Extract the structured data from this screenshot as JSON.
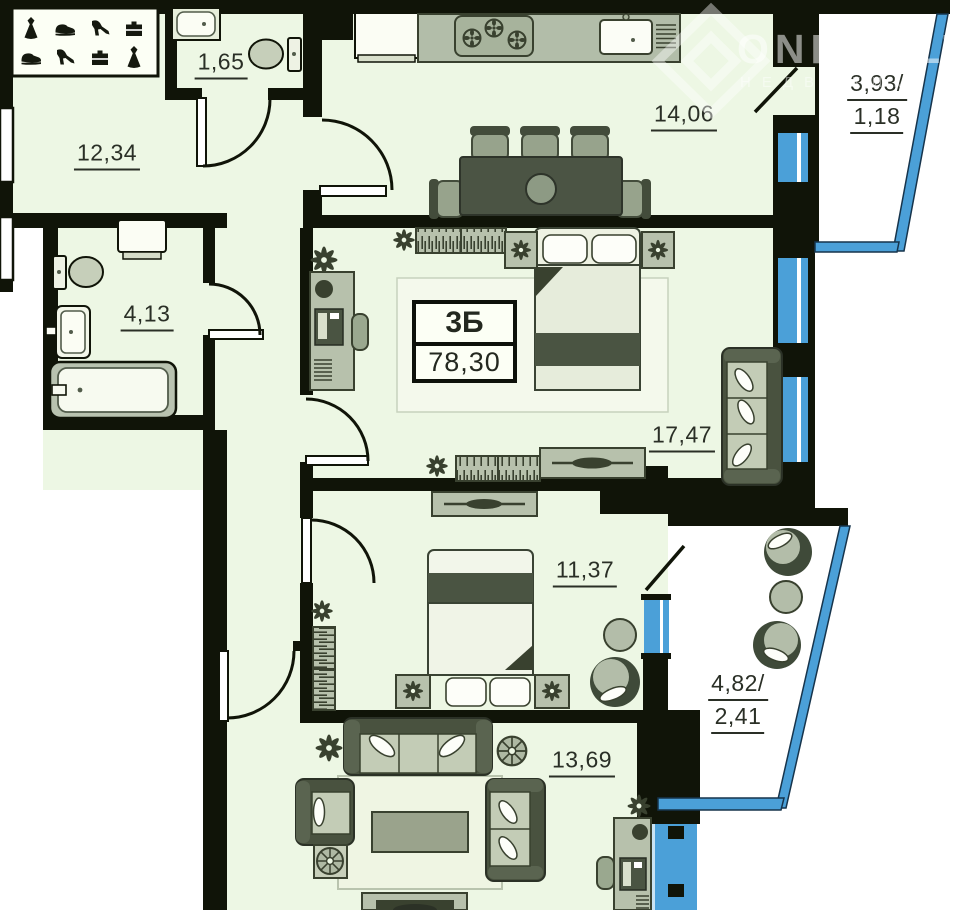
{
  "watermark": {
    "brand": "ONREALT",
    "subtitle": "НЕДВИЖИМ"
  },
  "unit": {
    "type_label": "3Б",
    "total_area": "78,30"
  },
  "rooms": {
    "hallway": {
      "area": "12,34"
    },
    "wc": {
      "area": "1,65"
    },
    "kitchen_living": {
      "area": "14,06"
    },
    "balcony_top": {
      "area_line1": "3,93/",
      "area_line2": "1,18"
    },
    "bathroom": {
      "area": "4,13"
    },
    "bedroom_master": {
      "area": "17,47"
    },
    "bedroom_second": {
      "area": "11,37"
    },
    "balcony_side": {
      "area_line1": "4,82/",
      "area_line2": "2,41"
    },
    "living_room": {
      "area": "13,69"
    }
  },
  "colors": {
    "wall": "#101408",
    "room_fill": "#edf7e4",
    "balcony_fill": "#ffffff",
    "glazing_blue": "#4ba0d8",
    "furniture_fill": "#b7c1ac",
    "furniture_dark": "#49523f",
    "furniture_outline": "#39412f",
    "label_text": "#2a2f26"
  },
  "icons": {
    "wardrobe-row1": [
      "dress-icon",
      "sneaker-icon",
      "heel-shoe-icon",
      "briefcase-icon"
    ],
    "wardrobe-row2": [
      "sneaker-icon",
      "heel-shoe-icon",
      "briefcase-icon",
      "dress-icon"
    ],
    "fixtures": [
      "sink-icon",
      "toilet-icon",
      "bathtub-icon",
      "washing-machine-icon",
      "stove-burners-icon",
      "kitchen-sink-icon",
      "flower-icon",
      "plant-icon"
    ]
  }
}
